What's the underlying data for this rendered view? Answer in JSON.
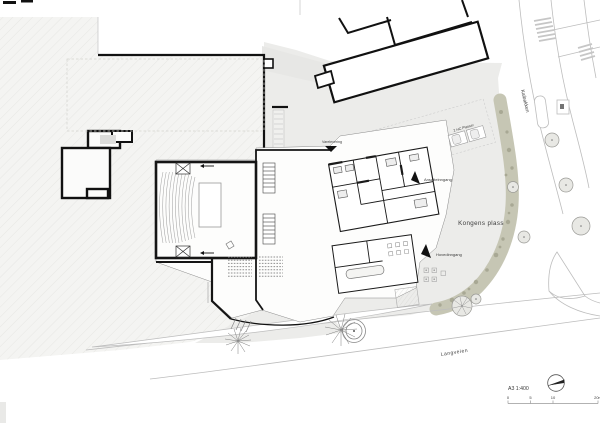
{
  "plan": {
    "place_labels": {
      "kongens_plass": "Kongens plass",
      "langveien": "Langveien",
      "kaibakken": "Kaibakken"
    },
    "entrance_labels": {
      "hovedinngang": "Hovedinngang",
      "ansatteinngang": "Ansatteinngang",
      "varelevering": "Varelevering"
    },
    "parking_label": "2 HC Plasser",
    "title_block": {
      "scale_text": "A3 1:400",
      "scale_ticks": [
        "0",
        "5",
        "10",
        "20m"
      ]
    },
    "colors": {
      "paper": "#ffffff",
      "site_gray": "#ececea",
      "hatch_gray": "#f4f4f2",
      "vegetation_band": "#c6c6b4",
      "vegetation_dot": "#a8a894",
      "wall_black": "#1a1a1a",
      "road_line_gray": "#bdbdbd"
    }
  }
}
